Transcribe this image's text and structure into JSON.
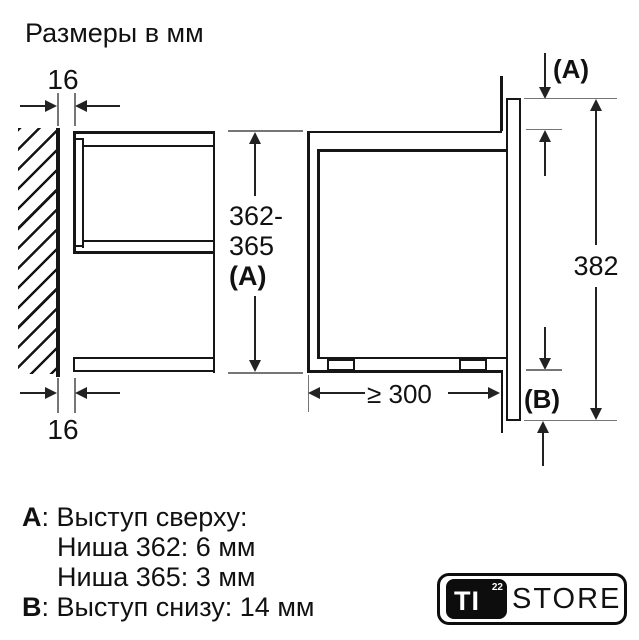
{
  "title": "Размеры в мм",
  "left_view": {
    "gap_top": "16",
    "gap_bottom": "16"
  },
  "height_dim": {
    "line1": "362-",
    "line2": "365",
    "line3": "(A)"
  },
  "right_view": {
    "overhang_top": "(A)",
    "front_height": "382",
    "overhang_bottom": "(B)",
    "min_depth": "≥ 300"
  },
  "notes": {
    "a_key": "A",
    "a_rest": ": Выступ сверху:",
    "a_niche_362": "Ниша 362: 6 мм",
    "a_niche_365": "Ниша 365: 3 мм",
    "b_key": "B",
    "b_rest": ": Выступ снизу: 14 мм"
  },
  "logo": {
    "brand": "TI",
    "sup": "22",
    "suffix": "STORE"
  },
  "colors": {
    "object_line": "#161616",
    "dimension_line": "#222222",
    "extension_line": "#767676",
    "background": "#ffffff",
    "logo_badge": "#0d0d0d"
  }
}
